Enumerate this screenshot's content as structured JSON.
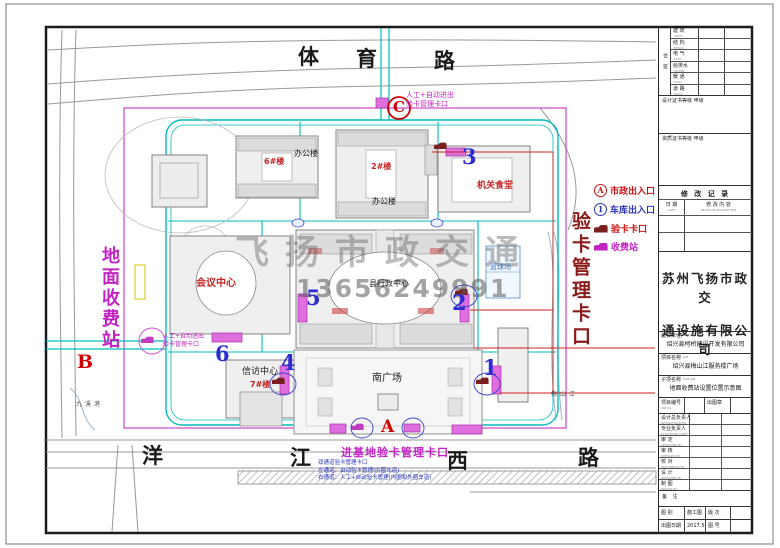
{
  "roads": {
    "top": [
      "体",
      "育",
      "路"
    ],
    "bottom": [
      "洋",
      "江",
      "西",
      "路"
    ]
  },
  "site": {
    "left_station_label": "地面收费站",
    "right_checkpoint_label": "验卡管理卡口",
    "watermark": {
      "brand": "飞扬市政交通",
      "phone": "13656249991"
    },
    "buildings": {
      "office_block_6": "6#楼",
      "office_label_1": "办公楼",
      "office_block_2": "2#楼",
      "office_label_2": "办公楼",
      "canteen": "机关食堂",
      "conference_center": "会议中心",
      "admin_center": "县行政中心",
      "basketball_court": "篮球场",
      "petition_center": "信访中心",
      "building_7": "7#楼",
      "south_plaza": "南广场"
    },
    "water": {
      "river_right": "梅山江",
      "river_left": "九溪港"
    },
    "markers": {
      "A": "A",
      "B": "B",
      "C": "C",
      "n1": "1",
      "n2": "2",
      "n3": "3",
      "n4": "4",
      "n5": "5",
      "n6": "6"
    },
    "gates": {
      "top_note_line1": "人工+自动进出",
      "top_note_line2": "验卡管理卡口",
      "left_note_line1": "人工+自动进出",
      "left_note_line2": "验卡管理卡口",
      "bottom_title": "进基地验卡管理卡口",
      "bottom_note1": "双通道验卡管理卡口",
      "bottom_note2": "左通道：自动验卡管理(内圈车道)",
      "bottom_note3": "右通道：人工+自动验卡管理(内圈和外圈车道)"
    }
  },
  "legend": {
    "items": [
      {
        "symbol": "A",
        "label": "市政出入口"
      },
      {
        "symbol": "1",
        "label": "车库出入口"
      },
      {
        "symbol": "car",
        "label": "验卡卡口"
      },
      {
        "symbol": "car",
        "label": "收费站"
      }
    ]
  },
  "tb": {
    "signoff_side": "会 签",
    "signoff_rows": [
      {
        "cn": "建 筑",
        "en": "ARCH."
      },
      {
        "cn": "结 构",
        "en": "STRUC."
      },
      {
        "cn": "电 气",
        "en": "ELEC."
      },
      {
        "cn": "给排水",
        "en": "PLUMB."
      },
      {
        "cn": "暖 通",
        "en": "HVAC"
      },
      {
        "cn": "道 路",
        "en": "ROAD"
      }
    ],
    "cert1": "设计证书等级 甲级",
    "cert2": "资质证书等级 甲级",
    "rev_title": "修 改 记 录",
    "rev_date": "日 期",
    "rev_date_en": "DATE",
    "rev_desc": "修 改 内 容",
    "rev_desc_en": "REVISION DESCRIPTION",
    "company1": "苏州飞扬市政交",
    "company2": "通设施有限公司",
    "client_label": "建设单位",
    "client_en": "CLIENT",
    "client_value": "绍兴县柯桥建设开发有限公司",
    "job_label": "项目名称",
    "job_en": "JOB",
    "job_value": "绍兴县梅山江服务楼广场",
    "subjob_label": "子项名称",
    "subjob_en": "SUB JOB",
    "subjob_value": "地面收费站设置位置示意图",
    "jobno_label": "项目编号",
    "jobno_en": "JOB No.",
    "seal_label": "出图章",
    "people": [
      {
        "cn": "设计总负责人",
        "en": "DESIGN MASTER"
      },
      {
        "cn": "专业负责人",
        "en": "DISCIPLINE CHIEF"
      },
      {
        "cn": "审 定",
        "en": "APPROVED BY"
      },
      {
        "cn": "审 核",
        "en": "CHECKED BY"
      },
      {
        "cn": "校 对",
        "en": "PROOFREAD BY"
      },
      {
        "cn": "设 计",
        "en": "DESIGNED BY"
      },
      {
        "cn": "制 图",
        "en": "DRAWN BY"
      }
    ],
    "note_label": "备 注",
    "b1_label": "图 别",
    "b1_value": "施工图",
    "b2_label": "版 次",
    "b2_value": "",
    "b3_label": "出图日期",
    "b3_value": "2017.5",
    "b4_label": "图 号",
    "b4_value": ""
  }
}
